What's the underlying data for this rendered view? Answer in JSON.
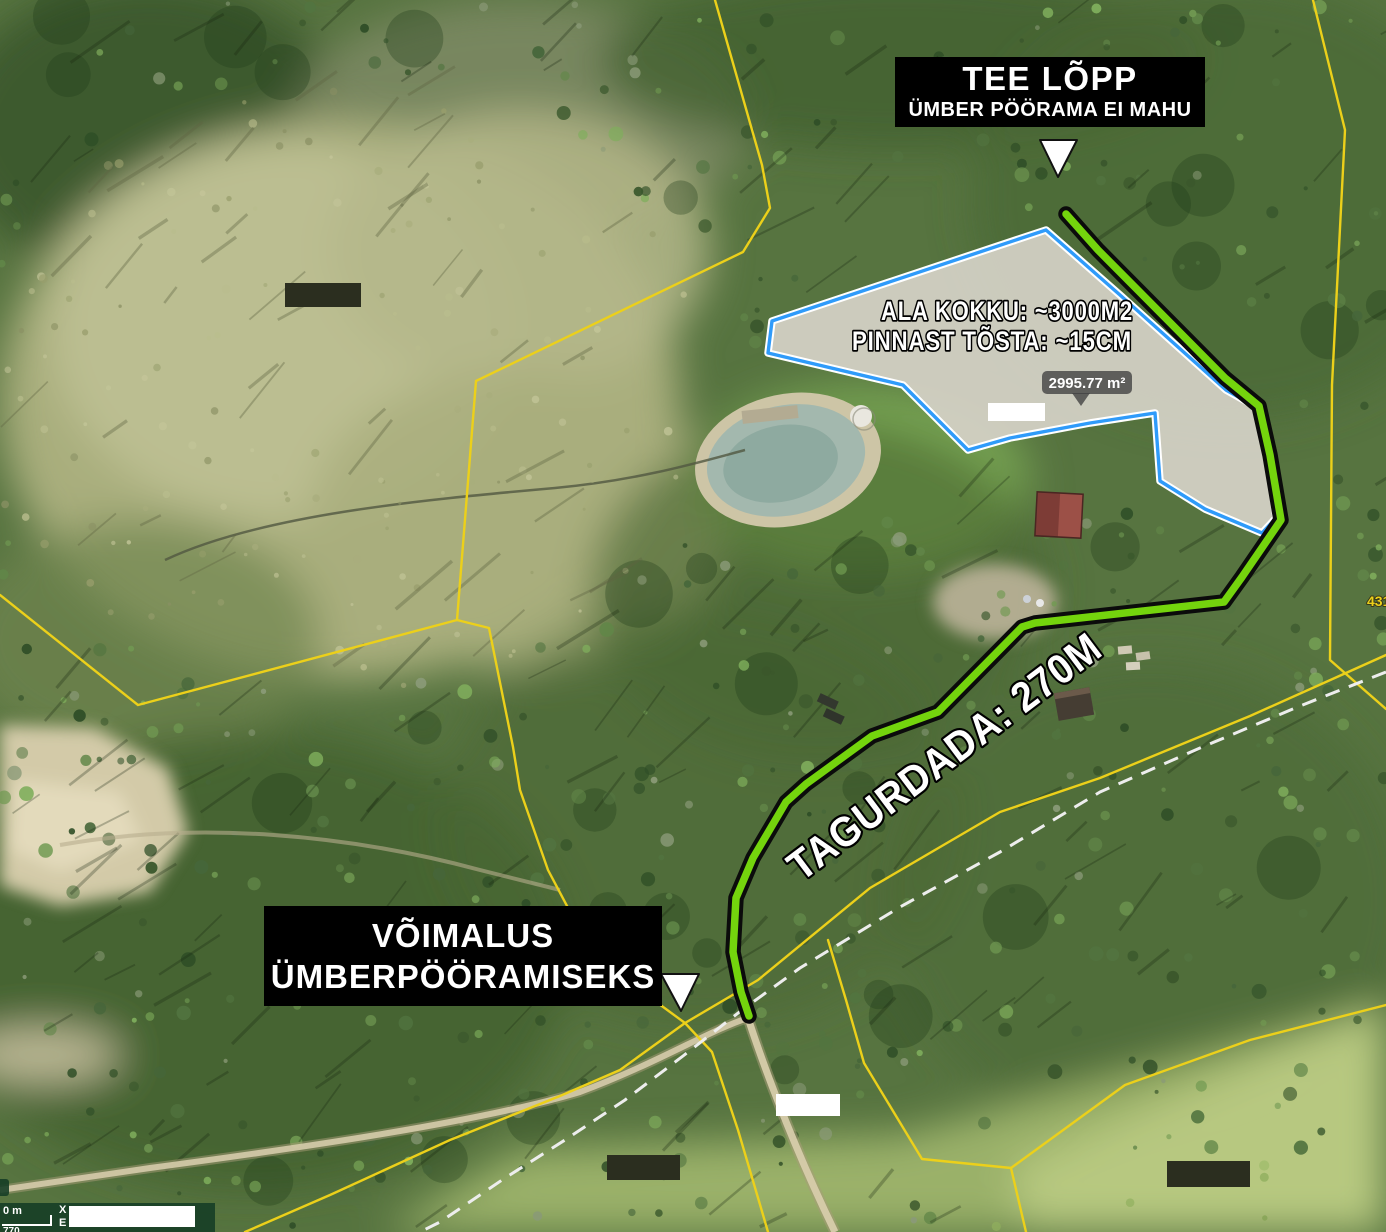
{
  "map": {
    "labels": {
      "road_end_title": "TEE LÕPP",
      "road_end_sub": "ÜMBER PÖÖRAMA EI MAHU",
      "area_line1": "ALA KOKKU: ~3000M2",
      "area_line2": "PINNAST TÕSTA: ~15CM",
      "measurement": "2995.77 m²",
      "route_label": "TAGURDADA: 270M",
      "turn_line1": "VÕIMALUS",
      "turn_line2": "ÜMBERPÖÖRAMISEKS",
      "parcel_number": "431"
    },
    "statusbar": {
      "scale_label": "0 m",
      "scale_value": "770",
      "coord_x": "X",
      "coord_y": "E"
    },
    "colors": {
      "route_green": "#74d40d",
      "route_casing": "#0b0b0b",
      "area_outline": "#2f9bfa",
      "area_casing": "#ffffff",
      "cadastral_yellow": "#ecd01a",
      "dashed_line": "#ededed",
      "label_bg": "#000000",
      "label_text": "#ffffff",
      "measure_bubble": "rgba(66,66,66,0.8)"
    }
  }
}
